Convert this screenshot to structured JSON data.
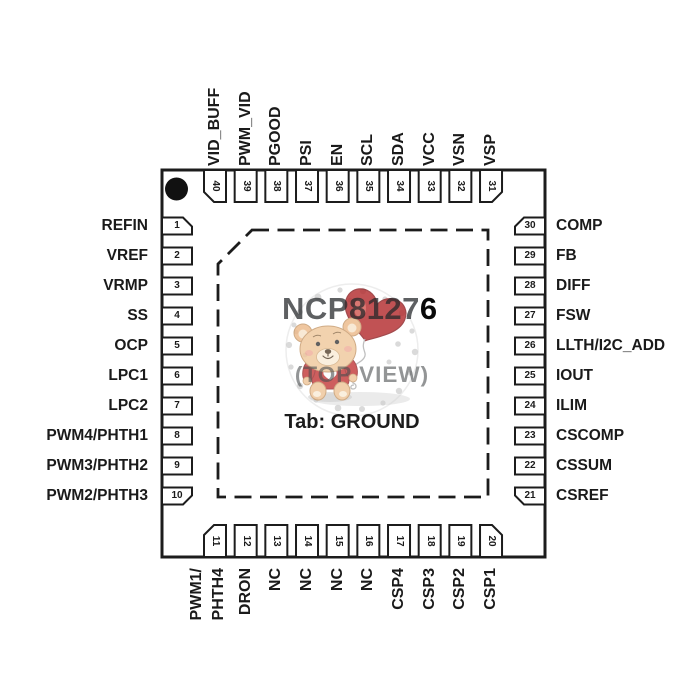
{
  "title": {
    "part_left": "NCP8127",
    "part_right": "6",
    "view_label": "(TOP VIEW)",
    "tab_label": "Tab: GROUND"
  },
  "pins": {
    "top": [
      {
        "num": "40",
        "label": "VID_BUFF"
      },
      {
        "num": "39",
        "label": "PWM_VID"
      },
      {
        "num": "38",
        "label": "PGOOD"
      },
      {
        "num": "37",
        "label": "PSI"
      },
      {
        "num": "36",
        "label": "EN"
      },
      {
        "num": "35",
        "label": "SCL"
      },
      {
        "num": "34",
        "label": "SDA"
      },
      {
        "num": "33",
        "label": "VCC"
      },
      {
        "num": "32",
        "label": "VSN"
      },
      {
        "num": "31",
        "label": "VSP"
      }
    ],
    "left": [
      {
        "num": "1",
        "label": "REFIN"
      },
      {
        "num": "2",
        "label": "VREF"
      },
      {
        "num": "3",
        "label": "VRMP"
      },
      {
        "num": "4",
        "label": "SS"
      },
      {
        "num": "5",
        "label": "OCP"
      },
      {
        "num": "6",
        "label": "LPC1"
      },
      {
        "num": "7",
        "label": "LPC2"
      },
      {
        "num": "8",
        "label": "PWM4/PHTH1"
      },
      {
        "num": "9",
        "label": "PWM3/PHTH2"
      },
      {
        "num": "10",
        "label": "PWM2/PHTH3"
      }
    ],
    "right": [
      {
        "num": "30",
        "label": "COMP"
      },
      {
        "num": "29",
        "label": "FB"
      },
      {
        "num": "28",
        "label": "DIFF"
      },
      {
        "num": "27",
        "label": "FSW"
      },
      {
        "num": "26",
        "label": "LLTH/I2C_ADD"
      },
      {
        "num": "25",
        "label": "IOUT"
      },
      {
        "num": "24",
        "label": "ILIM"
      },
      {
        "num": "23",
        "label": "CSCOMP"
      },
      {
        "num": "22",
        "label": "CSSUM"
      },
      {
        "num": "21",
        "label": "CSREF"
      }
    ],
    "bottom": [
      {
        "num": "11",
        "label": "PWM1/",
        "label2": "PHTH4"
      },
      {
        "num": "12",
        "label": "DRON"
      },
      {
        "num": "13",
        "label": "NC"
      },
      {
        "num": "14",
        "label": "NC"
      },
      {
        "num": "15",
        "label": "NC"
      },
      {
        "num": "16",
        "label": "NC"
      },
      {
        "num": "17",
        "label": "CSP4"
      },
      {
        "num": "18",
        "label": "CSP3"
      },
      {
        "num": "19",
        "label": "CSP2"
      },
      {
        "num": "20",
        "label": "CSP1"
      }
    ]
  },
  "colors": {
    "line": "#1c1c1c",
    "label_text": "#1a1a1a",
    "balloon_red": "#b2282a",
    "shirt_red": "#c23637",
    "bear_fur": "#efc79b",
    "watermark_dot": "#d4d4d4"
  }
}
